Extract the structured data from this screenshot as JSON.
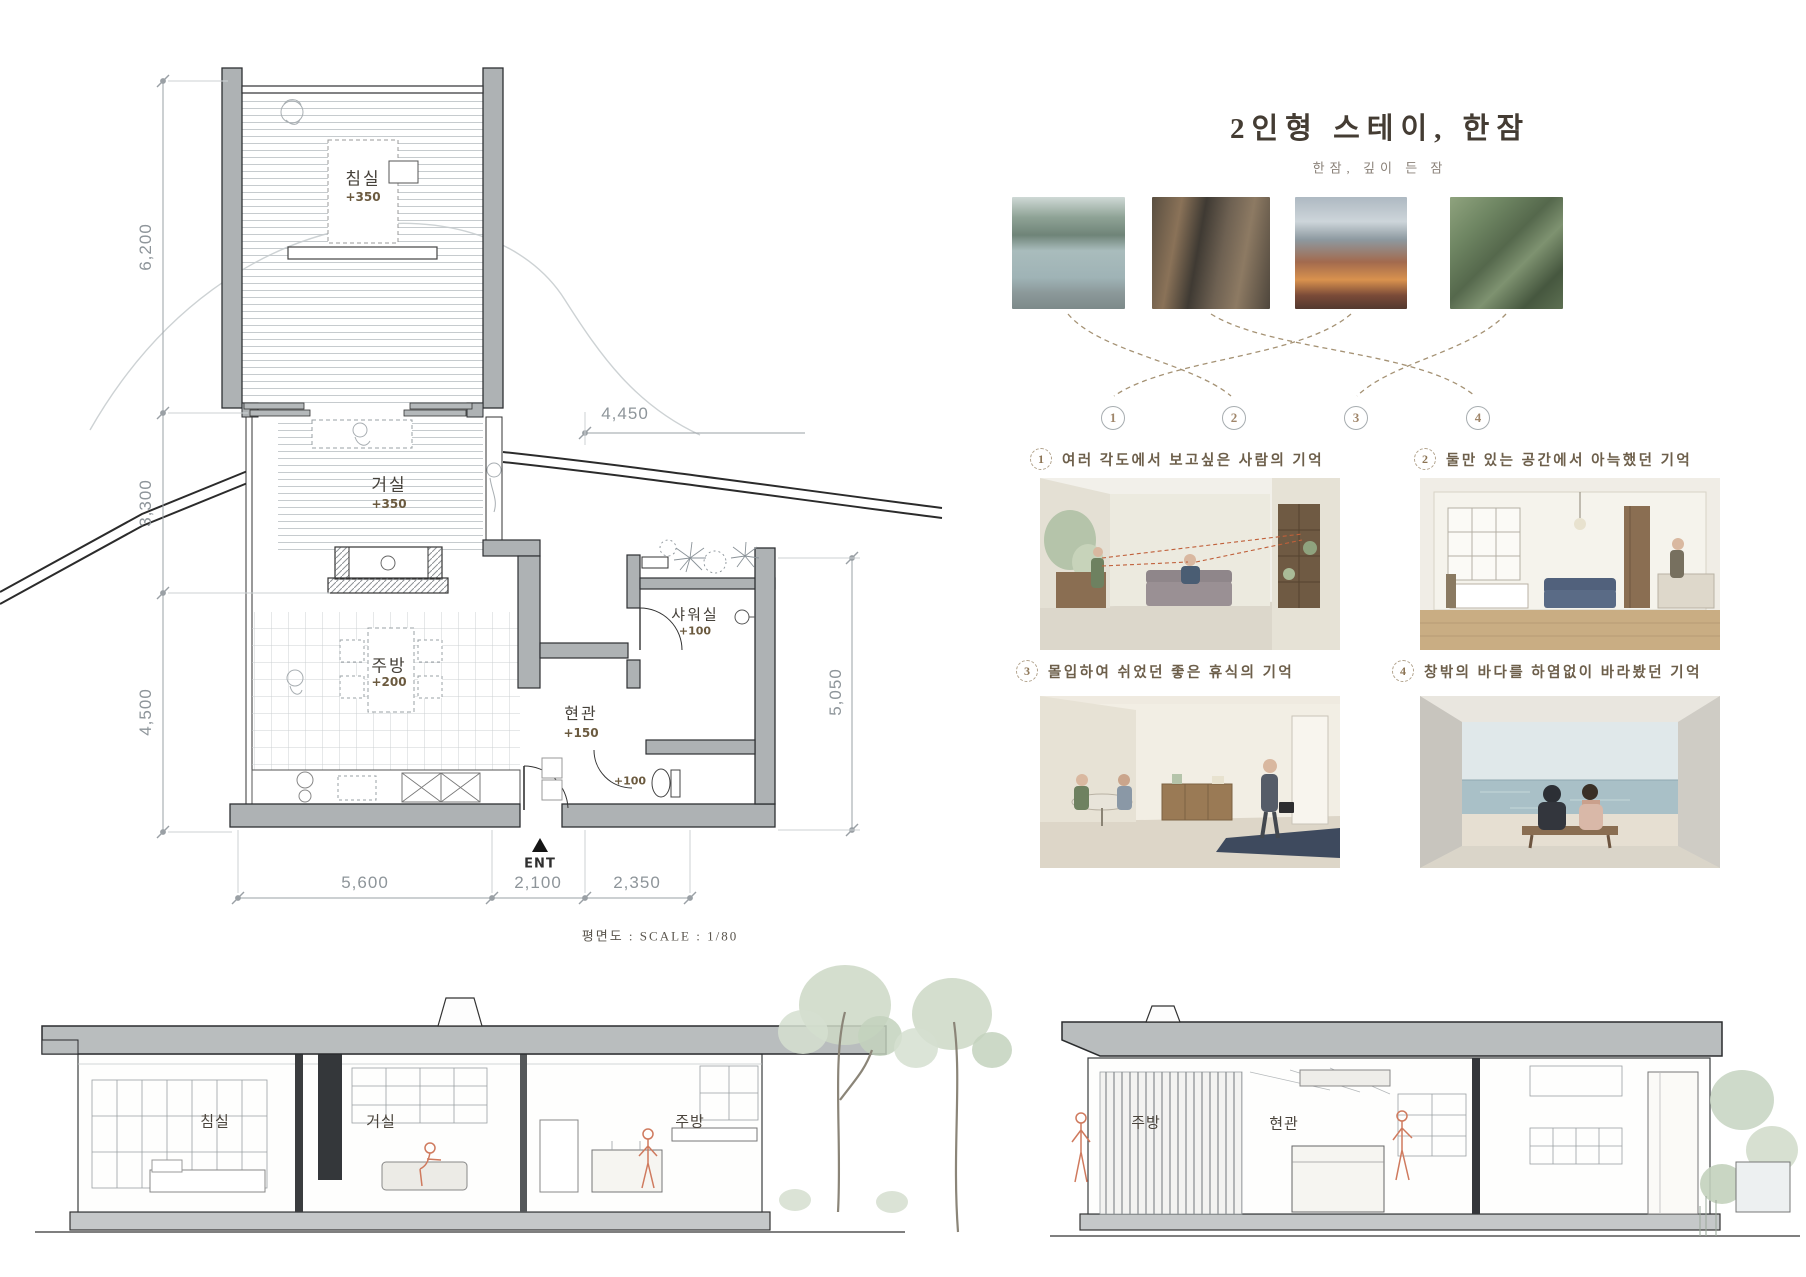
{
  "plan": {
    "rooms": {
      "bedroom": {
        "name": "침실",
        "level": "+350"
      },
      "living": {
        "name": "거실",
        "level": "+350"
      },
      "kitchen": {
        "name": "주방",
        "level": "+200"
      },
      "entrance": {
        "name": "현관",
        "level": "+150"
      },
      "shower": {
        "name": "샤워실",
        "level": "+100"
      },
      "toilet": {
        "level": "+100"
      }
    },
    "dimensions": {
      "left_upper": "6,200",
      "left_middle": "3,300",
      "left_lower": "4,500",
      "top_right": "4,450",
      "right": "5,050",
      "bottom_left": "5,600",
      "bottom_middle": "2,100",
      "bottom_right": "2,350"
    },
    "entrance_marker": "ENT",
    "scale_note": "평면도 : SCALE : 1/80"
  },
  "concept_panel": {
    "title": "2인형 스테이, 한잠",
    "subtitle": "한잠, 깊이 든 잠",
    "photos": [
      {
        "name": "couple-by-lake"
      },
      {
        "name": "reading-on-porch"
      },
      {
        "name": "couple-by-campfire"
      },
      {
        "name": "couple-in-garden"
      }
    ],
    "connector_numbers": [
      "1",
      "2",
      "3",
      "4"
    ],
    "memories": [
      {
        "no": "1",
        "caption": "여러 각도에서 보고싶은 사람의 기억"
      },
      {
        "no": "2",
        "caption": "둘만 있는 공간에서 아늑했던 기억"
      },
      {
        "no": "3",
        "caption": "몰입하여 쉬었던 좋은 휴식의 기억"
      },
      {
        "no": "4",
        "caption": "창밖의 바다를 하염없이 바라봤던 기억"
      }
    ]
  },
  "sections": {
    "left_section": {
      "labels": [
        "침실",
        "거실",
        "주방"
      ]
    },
    "right_section": {
      "labels": [
        "주방",
        "현관"
      ]
    }
  },
  "colors": {
    "accent_brown": "#a0866a",
    "caption_brown": "#6d5f4b",
    "wall_gray": "#aeb2b4",
    "roof_gray": "#b9bdbe",
    "red_figure": "#cf7a5e",
    "dim_gray": "#8e959a"
  }
}
